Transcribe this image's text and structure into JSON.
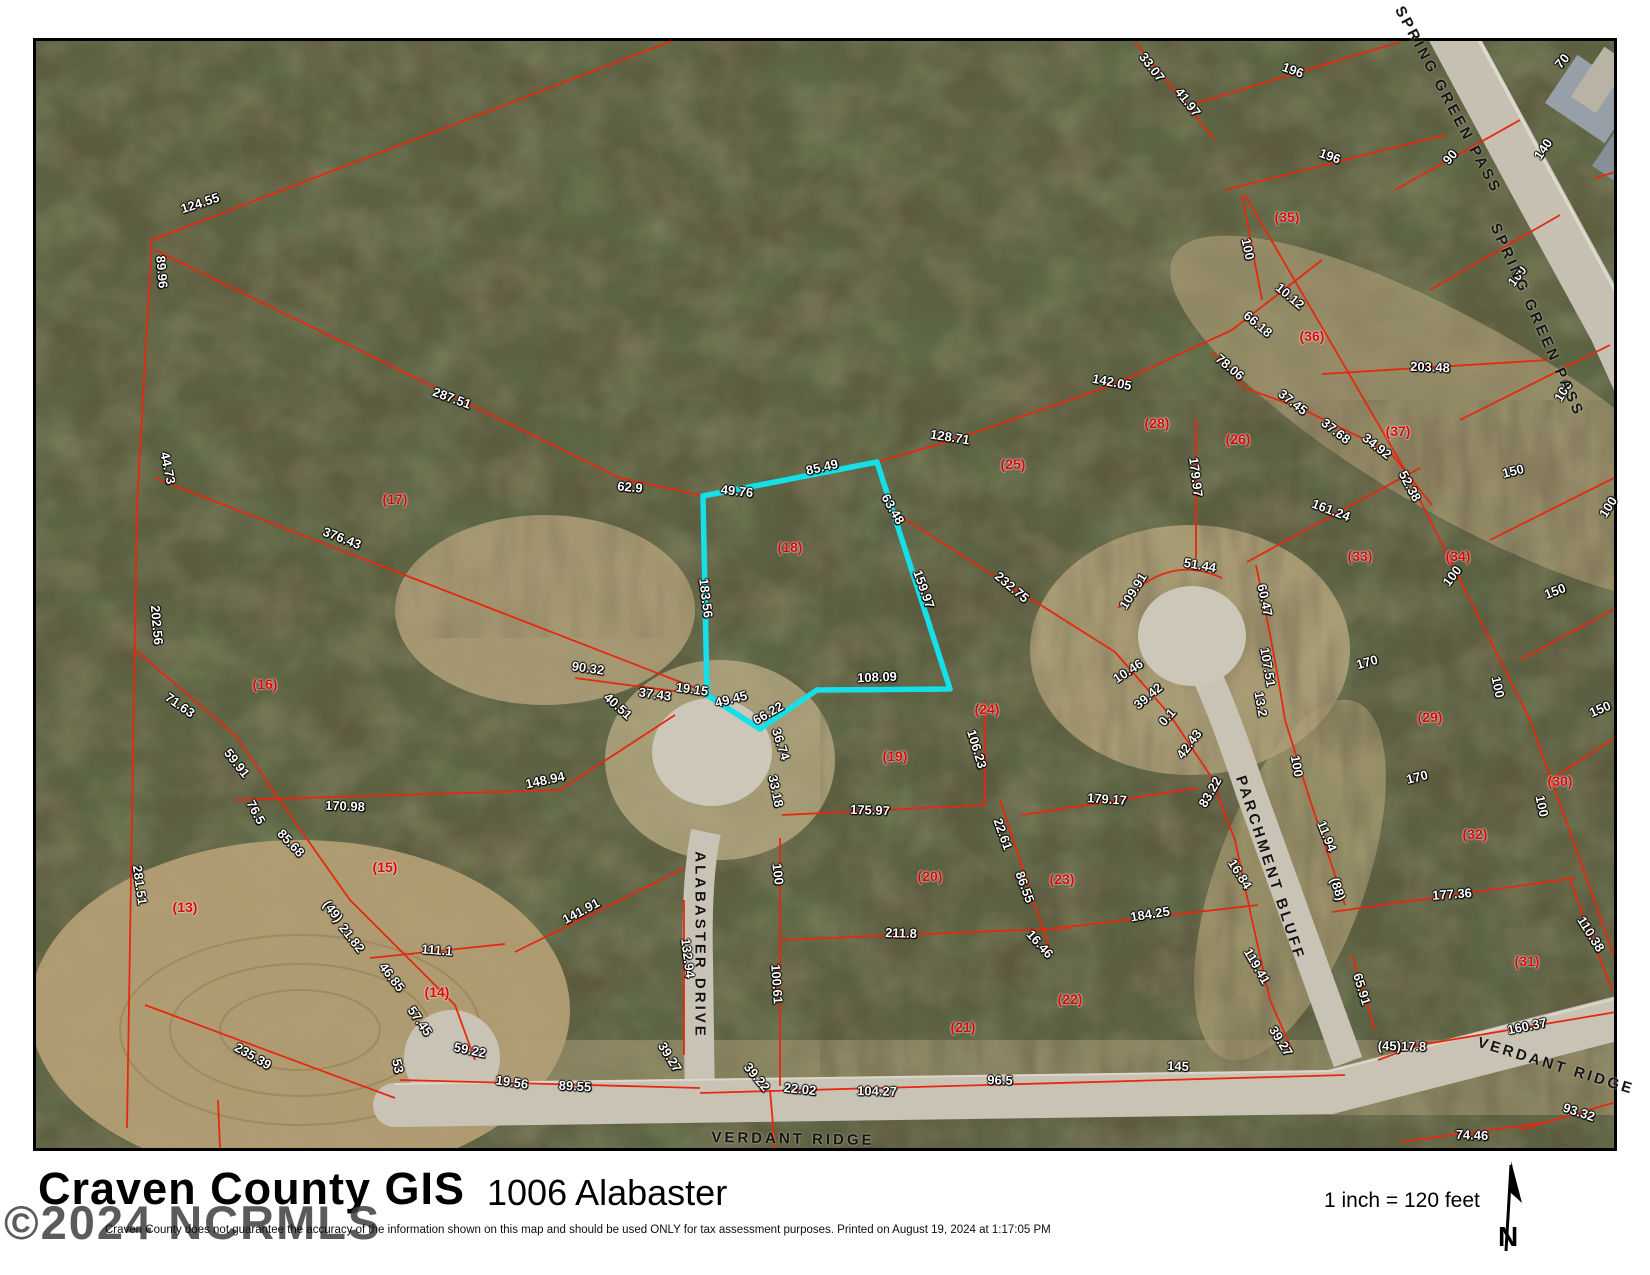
{
  "footer": {
    "title": "Craven County GIS",
    "address": "1006 Alabaster",
    "watermark": "©2024 NCRMLS",
    "disclaimer": "Craven County does not guarantee the accuracy of the information shown on this map and should be used ONLY for tax assessment purposes.   Printed on August 19, 2024 at 1:17:05 PM",
    "scale_text": "1 inch = 120 feet",
    "north_label": "N"
  },
  "map": {
    "highlight_color": "#16dfe8",
    "parcel_line_color": "#e8270f",
    "highlighted_lot": "(18)",
    "road_names": [
      "ALABASTER DRIVE",
      "PARCHMENT BLUFF",
      "VERDANT RIDGE",
      "SPRING GREEN PASS"
    ],
    "labels": [
      [
        "124.55",
        200,
        203,
        -18,
        "d"
      ],
      [
        "89.96",
        162,
        272,
        85,
        "d"
      ],
      [
        "44.73",
        168,
        468,
        78,
        "d"
      ],
      [
        "202.56",
        157,
        625,
        85,
        "d"
      ],
      [
        "281.51",
        140,
        885,
        82,
        "d"
      ],
      [
        "287.51",
        452,
        398,
        20,
        "d"
      ],
      [
        "376.43",
        342,
        538,
        21,
        "d"
      ],
      [
        "62.9",
        630,
        487,
        5,
        "d"
      ],
      [
        "71.63",
        180,
        705,
        35,
        "d"
      ],
      [
        "59.91",
        237,
        763,
        52,
        "d"
      ],
      [
        "76.5",
        256,
        812,
        62,
        "d"
      ],
      [
        "170.98",
        345,
        806,
        2,
        "d"
      ],
      [
        "148.94",
        545,
        780,
        -12,
        "d"
      ],
      [
        "85.68",
        291,
        843,
        46,
        "d"
      ],
      [
        "(49)",
        333,
        911,
        52,
        "d"
      ],
      [
        "21.82",
        352,
        938,
        52,
        "d"
      ],
      [
        "46.85",
        392,
        977,
        52,
        "d"
      ],
      [
        "111.1",
        437,
        950,
        4,
        "d"
      ],
      [
        "141.91",
        581,
        911,
        -28,
        "d"
      ],
      [
        "235.39",
        253,
        1056,
        30,
        "d"
      ],
      [
        "57.45",
        420,
        1021,
        55,
        "d"
      ],
      [
        "59.22",
        470,
        1050,
        12,
        "d"
      ],
      [
        "53",
        398,
        1066,
        78,
        "d"
      ],
      [
        "19.56",
        512,
        1082,
        8,
        "d"
      ],
      [
        "89.55",
        575,
        1086,
        3,
        "d"
      ],
      [
        "90.32",
        588,
        668,
        8,
        "d"
      ],
      [
        "40.51",
        618,
        706,
        42,
        "d"
      ],
      [
        "37.43",
        655,
        694,
        8,
        "d"
      ],
      [
        "19.15",
        692,
        689,
        8,
        "d"
      ],
      [
        "49.45",
        731,
        699,
        -14,
        "d"
      ],
      [
        "66.22",
        768,
        713,
        -30,
        "d"
      ],
      [
        "36.74",
        781,
        744,
        72,
        "d"
      ],
      [
        "33.18",
        776,
        791,
        78,
        "d"
      ],
      [
        "49.76",
        737,
        491,
        6,
        "d"
      ],
      [
        "85.49",
        822,
        467,
        -13,
        "d"
      ],
      [
        "63.48",
        893,
        509,
        60,
        "d"
      ],
      [
        "159.97",
        924,
        589,
        70,
        "d"
      ],
      [
        "183.56",
        706,
        598,
        83,
        "d"
      ],
      [
        "108.09",
        877,
        677,
        -2,
        "d"
      ],
      [
        "128.71",
        950,
        437,
        9,
        "d"
      ],
      [
        "142.05",
        1112,
        382,
        11,
        "d"
      ],
      [
        "232.75",
        1012,
        587,
        40,
        "d"
      ],
      [
        "106.23",
        977,
        749,
        73,
        "d"
      ],
      [
        "175.97",
        870,
        810,
        2,
        "d"
      ],
      [
        "211.8",
        901,
        933,
        2,
        "d"
      ],
      [
        "100",
        778,
        874,
        83,
        "d"
      ],
      [
        "100.61",
        777,
        984,
        86,
        "d"
      ],
      [
        "132.94",
        688,
        958,
        83,
        "d"
      ],
      [
        "39.27",
        670,
        1057,
        58,
        "d"
      ],
      [
        "39.22",
        757,
        1077,
        50,
        "d"
      ],
      [
        "22.02",
        800,
        1089,
        6,
        "d"
      ],
      [
        "104.27",
        877,
        1091,
        1,
        "d"
      ],
      [
        "96.5",
        1000,
        1080,
        1,
        "d"
      ],
      [
        "145",
        1178,
        1066,
        2,
        "d"
      ],
      [
        "22.61",
        1003,
        834,
        70,
        "d"
      ],
      [
        "86.55",
        1025,
        887,
        70,
        "d"
      ],
      [
        "16.46",
        1040,
        944,
        48,
        "d"
      ],
      [
        "179.17",
        1107,
        799,
        4,
        "d"
      ],
      [
        "184.25",
        1150,
        914,
        -9,
        "d"
      ],
      [
        "179.97",
        1196,
        477,
        83,
        "d"
      ],
      [
        "51.44",
        1200,
        565,
        10,
        "d"
      ],
      [
        "109.91",
        1133,
        591,
        -58,
        "d"
      ],
      [
        "10.46",
        1128,
        671,
        -33,
        "d"
      ],
      [
        "39.42",
        1148,
        696,
        -40,
        "d"
      ],
      [
        "0.1",
        1167,
        717,
        -48,
        "d"
      ],
      [
        "42.43",
        1189,
        744,
        -53,
        "d"
      ],
      [
        "83.22",
        1210,
        792,
        -60,
        "d"
      ],
      [
        "60.47",
        1265,
        600,
        78,
        "d"
      ],
      [
        "107.51",
        1268,
        667,
        80,
        "d"
      ],
      [
        "13.2",
        1261,
        704,
        80,
        "d"
      ],
      [
        "100",
        1297,
        766,
        80,
        "d"
      ],
      [
        "11.94",
        1327,
        836,
        68,
        "d"
      ],
      [
        "16.84",
        1240,
        874,
        58,
        "d"
      ],
      [
        "119.41",
        1257,
        966,
        60,
        "d"
      ],
      [
        "39.27",
        1281,
        1041,
        58,
        "d"
      ],
      [
        "(88)",
        1338,
        889,
        72,
        "d"
      ],
      [
        "65.91",
        1362,
        989,
        73,
        "d"
      ],
      [
        "(45)17.8",
        1402,
        1046,
        1,
        "d"
      ],
      [
        "160.37",
        1527,
        1026,
        -11,
        "d"
      ],
      [
        "177.36",
        1452,
        894,
        -4,
        "d"
      ],
      [
        "110.38",
        1591,
        934,
        58,
        "d"
      ],
      [
        "93.32",
        1579,
        1112,
        18,
        "d"
      ],
      [
        "74.46",
        1472,
        1135,
        2,
        "d"
      ],
      [
        "161.24",
        1331,
        510,
        21,
        "d"
      ],
      [
        "170",
        1367,
        662,
        -16,
        "d"
      ],
      [
        "170",
        1417,
        777,
        -14,
        "d"
      ],
      [
        "150",
        1513,
        471,
        -14,
        "d"
      ],
      [
        "150",
        1555,
        591,
        -20,
        "d"
      ],
      [
        "150",
        1600,
        709,
        -23,
        "d"
      ],
      [
        "100",
        1452,
        576,
        -52,
        "d"
      ],
      [
        "100",
        1498,
        687,
        78,
        "d"
      ],
      [
        "100",
        1542,
        806,
        78,
        "d"
      ],
      [
        "100",
        1608,
        507,
        -58,
        "d"
      ],
      [
        "100",
        1517,
        276,
        -52,
        "d"
      ],
      [
        "100",
        1248,
        249,
        78,
        "d"
      ],
      [
        "100",
        1563,
        391,
        -58,
        "d"
      ],
      [
        "90",
        1450,
        157,
        -50,
        "d"
      ],
      [
        "140",
        1543,
        149,
        -56,
        "d"
      ],
      [
        "196",
        1293,
        70,
        20,
        "d"
      ],
      [
        "196",
        1330,
        156,
        20,
        "d"
      ],
      [
        "33.07",
        1152,
        67,
        52,
        "d"
      ],
      [
        "41.97",
        1188,
        102,
        52,
        "d"
      ],
      [
        "203.48",
        1430,
        367,
        2,
        "d"
      ],
      [
        "66.18",
        1258,
        324,
        40,
        "d"
      ],
      [
        "10.12",
        1290,
        296,
        40,
        "d"
      ],
      [
        "78.06",
        1230,
        367,
        40,
        "d"
      ],
      [
        "37.45",
        1293,
        402,
        38,
        "d"
      ],
      [
        "37.68",
        1336,
        431,
        38,
        "d"
      ],
      [
        "34.92",
        1377,
        446,
        38,
        "d"
      ],
      [
        "52.38",
        1410,
        486,
        62,
        "d"
      ],
      [
        "70",
        1562,
        61,
        -50,
        "d"
      ],
      [
        "(13)",
        185,
        907,
        0,
        "l"
      ],
      [
        "(14)",
        437,
        992,
        0,
        "l"
      ],
      [
        "(15)",
        385,
        867,
        0,
        "l"
      ],
      [
        "(16)",
        265,
        684,
        0,
        "l"
      ],
      [
        "(17)",
        395,
        499,
        0,
        "l"
      ],
      [
        "(18)",
        790,
        547,
        0,
        "l"
      ],
      [
        "(19)",
        895,
        756,
        0,
        "l"
      ],
      [
        "(20)",
        930,
        876,
        0,
        "l"
      ],
      [
        "(21)",
        963,
        1027,
        0,
        "l"
      ],
      [
        "(22)",
        1070,
        999,
        0,
        "l"
      ],
      [
        "(23)",
        1062,
        879,
        0,
        "l"
      ],
      [
        "(24)",
        987,
        709,
        0,
        "l"
      ],
      [
        "(25)",
        1013,
        464,
        0,
        "l"
      ],
      [
        "(26)",
        1238,
        439,
        0,
        "l"
      ],
      [
        "(28)",
        1157,
        423,
        0,
        "l"
      ],
      [
        "(29)",
        1430,
        717,
        0,
        "l"
      ],
      [
        "(30)",
        1560,
        781,
        0,
        "l"
      ],
      [
        "(31)",
        1527,
        961,
        0,
        "l"
      ],
      [
        "(32)",
        1475,
        834,
        0,
        "l"
      ],
      [
        "(33)",
        1360,
        556,
        0,
        "l"
      ],
      [
        "(34)",
        1458,
        556,
        0,
        "l"
      ],
      [
        "(35)",
        1287,
        217,
        0,
        "l"
      ],
      [
        "(36)",
        1312,
        336,
        0,
        "l"
      ],
      [
        "(37)",
        1398,
        431,
        0,
        "l"
      ],
      [
        "ALABASTER DRIVE",
        700,
        945,
        90,
        "r"
      ],
      [
        "PARCHMENT BLUFF",
        1270,
        868,
        72,
        "r"
      ],
      [
        "VERDANT RIDGE",
        793,
        1139,
        1,
        "r"
      ],
      [
        "VERDANT RIDGE",
        1556,
        1066,
        17,
        "r"
      ],
      [
        "SPRING GREEN PASS",
        1448,
        100,
        62,
        "r"
      ],
      [
        "SPRING GREEN PASS",
        1537,
        320,
        66,
        "r"
      ]
    ]
  }
}
